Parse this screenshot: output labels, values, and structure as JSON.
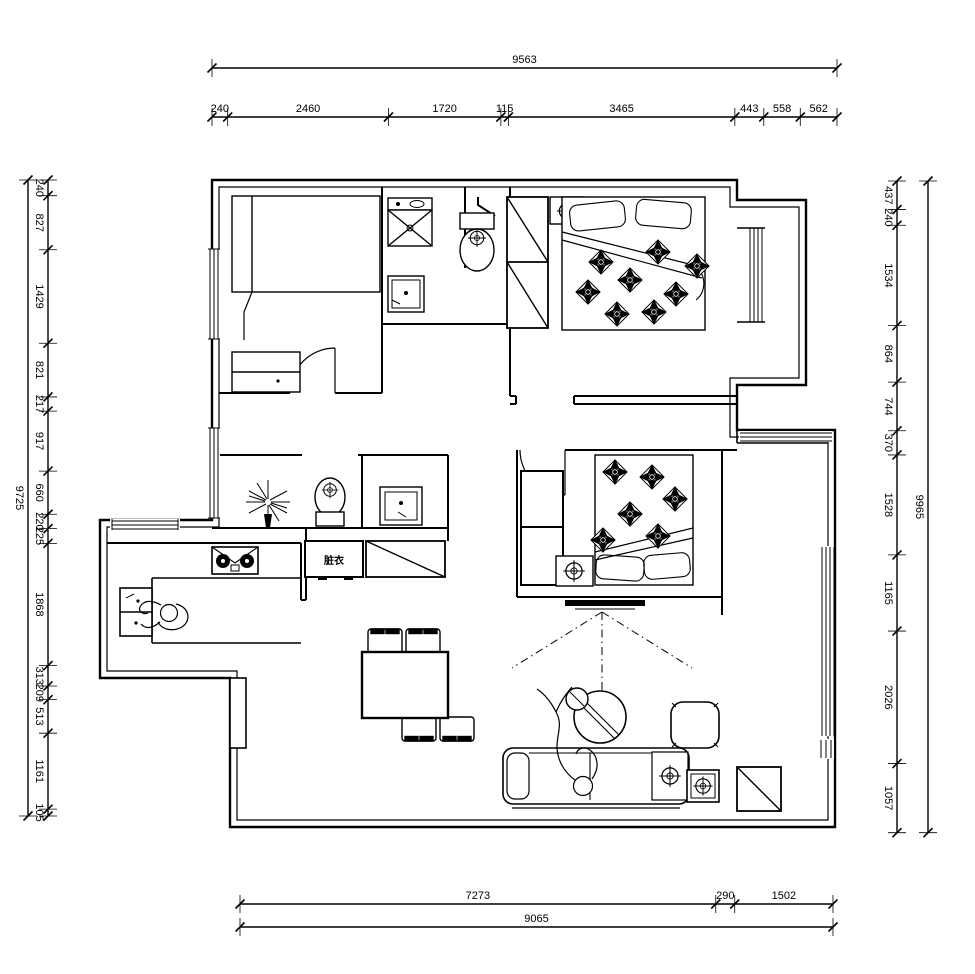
{
  "dims": {
    "top": {
      "total": "9563",
      "segments": [
        "240",
        "2460",
        "1720",
        "115",
        "3465",
        "443",
        "558",
        "562"
      ]
    },
    "bottom": {
      "total": "9065",
      "segments": [
        "7273",
        "290",
        "1502"
      ]
    },
    "left": {
      "total": "9725",
      "segments": [
        "240",
        "827",
        "1429",
        "821",
        "217",
        "917",
        "660",
        "220",
        "225",
        "1868",
        "313",
        "209",
        "513",
        "1161",
        "105"
      ]
    },
    "right": {
      "total": "9965",
      "segments": [
        "437",
        "240",
        "1534",
        "864",
        "744",
        "370",
        "1528",
        "1165",
        "2026",
        "1057"
      ]
    }
  },
  "labels": {
    "cabinet_text": "脏衣"
  },
  "furniture": [
    "washing-machine",
    "washbasin",
    "toilet",
    "wardrobe",
    "double-bed-1",
    "nightstand-lamp",
    "bay-window",
    "tatami-bed",
    "desk-cabinet",
    "door-arc",
    "plant",
    "toilet-2",
    "washbasin-2",
    "laundry-cabinet",
    "diagonal-cabinet",
    "gas-stove",
    "kitchen-counter",
    "sink-unit",
    "person-cooking",
    "dining-table",
    "chair",
    "double-bed-2",
    "wardrobe-2",
    "tv-set",
    "sofa",
    "person-lying",
    "round-coffee-table",
    "ottoman",
    "lamp-table",
    "entry-cabinet",
    "window"
  ],
  "colors": {
    "line": "#000000",
    "background": "#ffffff"
  }
}
